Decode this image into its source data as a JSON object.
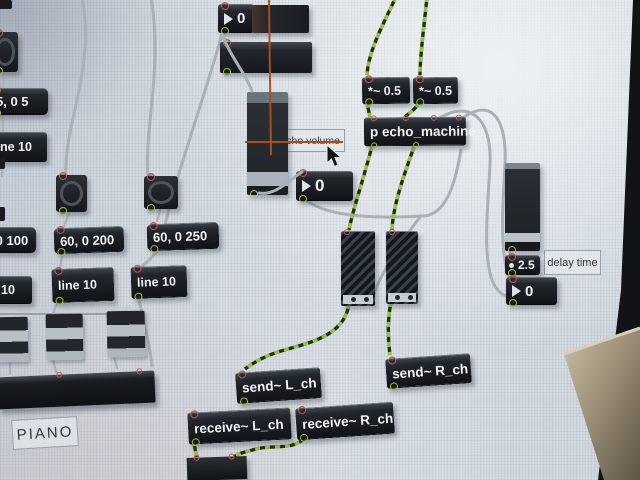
{
  "meta": {
    "app_title": "Max/MSP patcher window (photographed LCD screen)"
  },
  "colors": {
    "object_box_bg": "#1e2228",
    "object_text": "#f1f3f5",
    "cable_gray": "#a9b0b8",
    "signal_green": "#95c341",
    "crosshair_orange": "#a8501d",
    "inlet_red": "#c05a50",
    "outlet_green": "#a3b945",
    "background": "#d5dce2"
  },
  "numbers": {
    "top_display": "0",
    "volume_display": "0",
    "delay_multiplier": "2.5",
    "delay_display": "0"
  },
  "messages": {
    "piano_env": "5, 0 5",
    "ramp_100": "60, 0 100",
    "ramp_200": "60, 0 200",
    "ramp_250": "60, 0 250"
  },
  "objects": {
    "line10_top": "line 10",
    "line10_left": "line 10",
    "line10_mid": "line 10",
    "line10_right": "line 10",
    "mul_left": "*~ 0.5",
    "mul_right": "*~ 0.5",
    "patcher_echo": "p echo_machine",
    "send_l": "send~ L_ch",
    "send_r": "send~ R_ch",
    "recv_l": "receive~ L_ch",
    "recv_r": "receive~ R_ch"
  },
  "comments": {
    "echo_volume": "echo volume",
    "delay_time": "delay time",
    "piano": "PIANO"
  }
}
